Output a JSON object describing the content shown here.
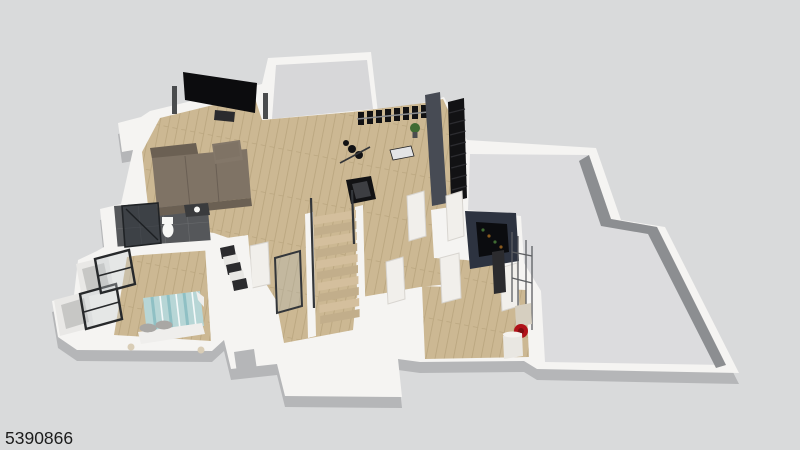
{
  "watermark": {
    "id": "5390866"
  },
  "scene": {
    "type": "3d-isometric-floor-plan-render",
    "level": "finished-basement",
    "rooms": [
      {
        "name": "media-room",
        "objects": [
          "flat-screen-tv",
          "tower-speaker-left",
          "tower-speaker-right",
          "media-console",
          "sectional-sofa",
          "ottoman"
        ]
      },
      {
        "name": "storage-room",
        "objects": []
      },
      {
        "name": "home-gym",
        "objects": [
          "dumbbell-rack",
          "weight-plates",
          "barbell",
          "workout-bench",
          "treadmill",
          "potted-plant"
        ]
      },
      {
        "name": "stairwell",
        "objects": [
          "dark-upper-staircase",
          "charcoal-partition-wall"
        ]
      },
      {
        "name": "staircase-hall",
        "objects": [
          "wood-staircase",
          "glass-railing",
          "landing-platform",
          "open-doors"
        ]
      },
      {
        "name": "wet-bar",
        "objects": [
          "navy-bar-counter",
          "bottle-shelf"
        ]
      },
      {
        "name": "bedroom",
        "objects": [
          "double-bed-teal-striped",
          "pillows",
          "table-lamps",
          "egress-window-1",
          "egress-window-2",
          "window-wells"
        ]
      },
      {
        "name": "bathroom",
        "objects": [
          "glass-shower",
          "toilet",
          "vanity"
        ]
      },
      {
        "name": "closet",
        "objects": [
          "hanging-clothes"
        ]
      },
      {
        "name": "utility-room",
        "objects": [
          "water-heater",
          "expansion-tank",
          "red-circulator-pump",
          "pipes",
          "electrical-panel"
        ]
      },
      {
        "name": "unfinished-basement",
        "objects": []
      }
    ]
  },
  "colors": {
    "background": "#d9dadb",
    "plate": "#f5f4f2",
    "plate-side": "#b5b6b8",
    "wall-face-dark": "#8c8e91",
    "concrete": "#dcdcde",
    "storage-floor": "#d7d7d9",
    "wood": "#ccb893",
    "wood-seam": "#b9a57e",
    "tread-a": "#d4bf9d",
    "tread-b": "#c2ae8b",
    "tile": "#55575a",
    "tv": "#0c0c0e",
    "speaker": "#4a4c4e",
    "sofa": "#7f7365",
    "sofa-dark": "#6b6053",
    "ottoman": "#837769",
    "charcoal": "#474b54",
    "stair-black": "#121214",
    "glass-tint": "#aeb9bd",
    "railing-frame": "#33363a",
    "door": "#f1efeb",
    "door-edge": "#d8d5d0",
    "bar-navy": "#2d3340",
    "bar-interior": "#0b0c0f",
    "clothes-dark": "#2b2b2e",
    "bed-teal": "#b7d6d6",
    "bed-stripe": "#8fc0c4",
    "sheet-white": "#efeeec",
    "pillow-gray": "#a9a7a4",
    "lamp-beige": "#d9cdb6",
    "tank-beige": "#d6cfc0",
    "tank-white": "#e9e7e2",
    "pump-red": "#b01219",
    "pipe": "#5c5e61",
    "plant-green": "#3f6b33",
    "winframe": "#27292b",
    "watermark": "#1c1c1c"
  }
}
